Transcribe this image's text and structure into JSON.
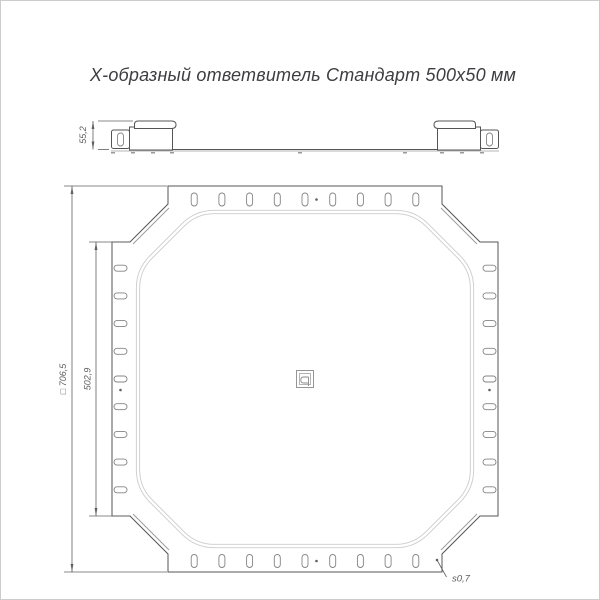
{
  "title": {
    "text": "Х-образный ответвитель Стандарт 500х50 мм"
  },
  "drawing": {
    "side_view": {
      "height_dimension": "55,2"
    },
    "plan_view": {
      "overall_dimension": "□ 706,5",
      "flange_dimension": "502,9",
      "thickness_callout": "s0,7",
      "slots_per_side": 9
    }
  },
  "colors": {
    "outline": "#555555",
    "secondary": "#999999",
    "plateau": "#cccccc",
    "dimension": "#606060",
    "slot": "#848484",
    "title": "#3d3d42",
    "frame": "#cccccc",
    "background": "#ffffff"
  }
}
